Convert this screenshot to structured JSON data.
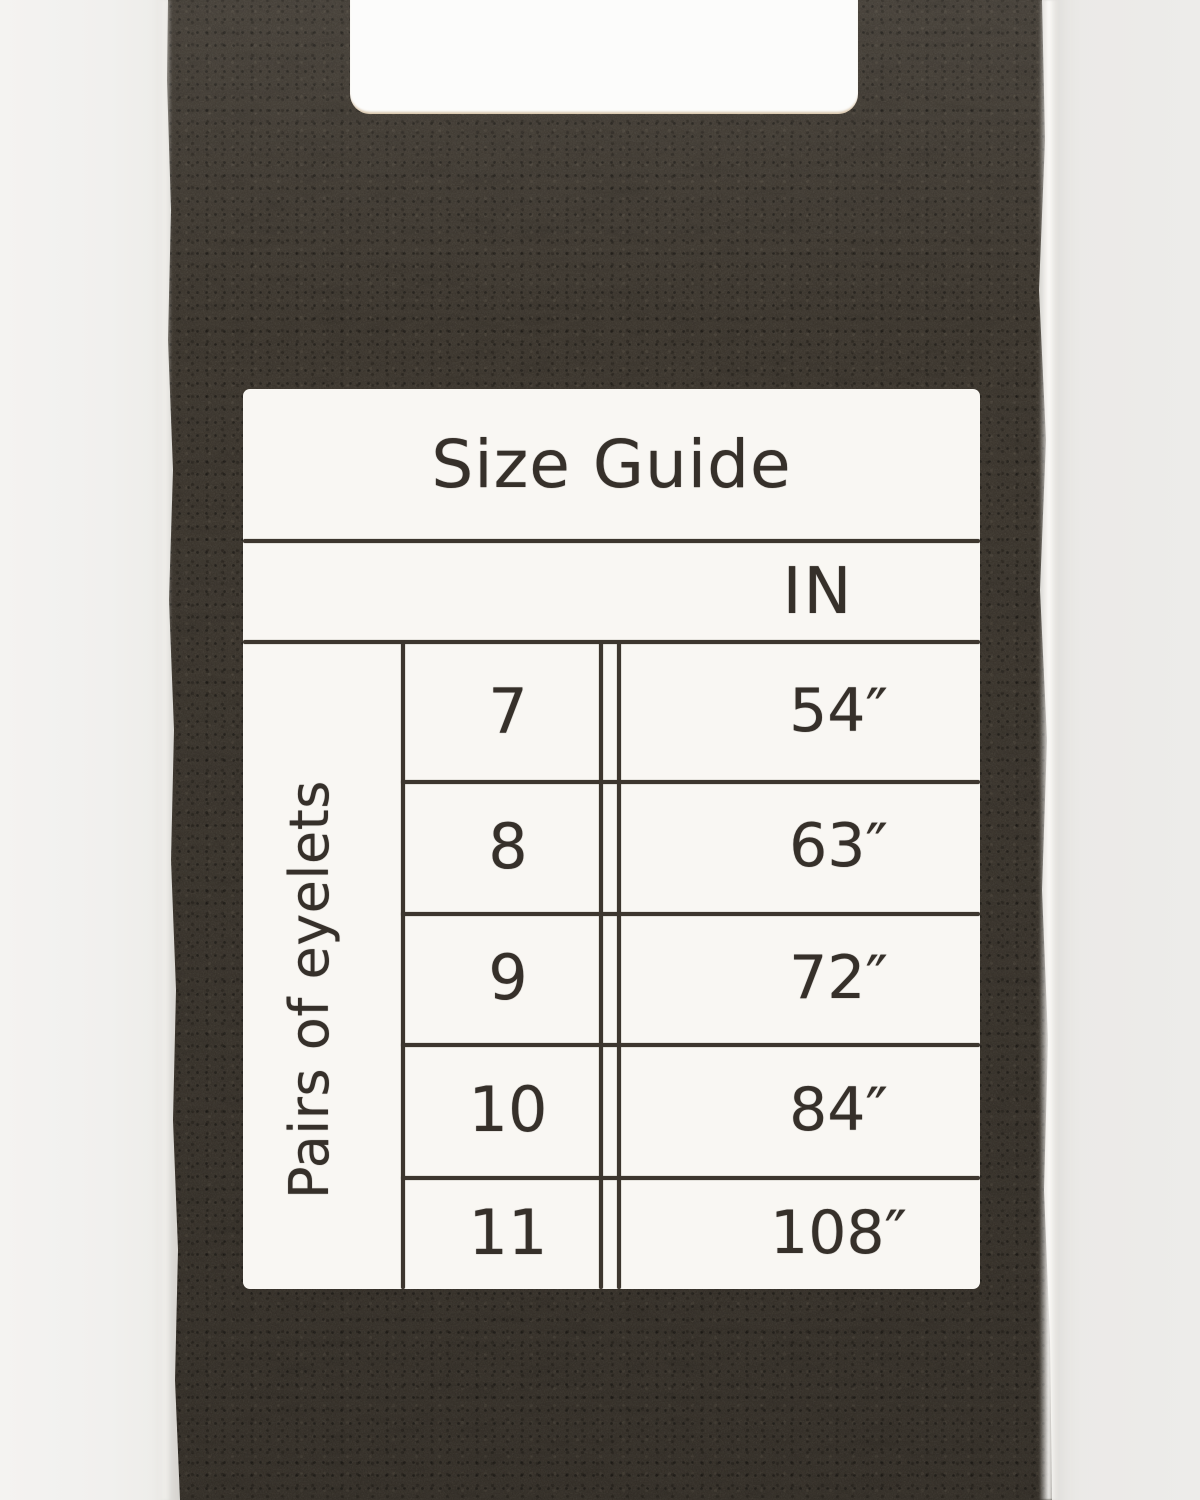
{
  "photo": {
    "colors": {
      "backdrop": "#edecea",
      "strap": "#39332b",
      "card": "#f9f7f3",
      "ink": "#36302a",
      "cut_edge_tan": "#c7a97a"
    }
  },
  "size_guide": {
    "title": "Size Guide",
    "unit_header": "IN",
    "row_axis_label": "Pairs of eyelets",
    "rows": [
      {
        "eyelets": "7",
        "inches": "54″"
      },
      {
        "eyelets": "8",
        "inches": "63″"
      },
      {
        "eyelets": "9",
        "inches": "72″"
      },
      {
        "eyelets": "10",
        "inches": "84″"
      },
      {
        "eyelets": "11",
        "inches": "108″"
      }
    ]
  }
}
